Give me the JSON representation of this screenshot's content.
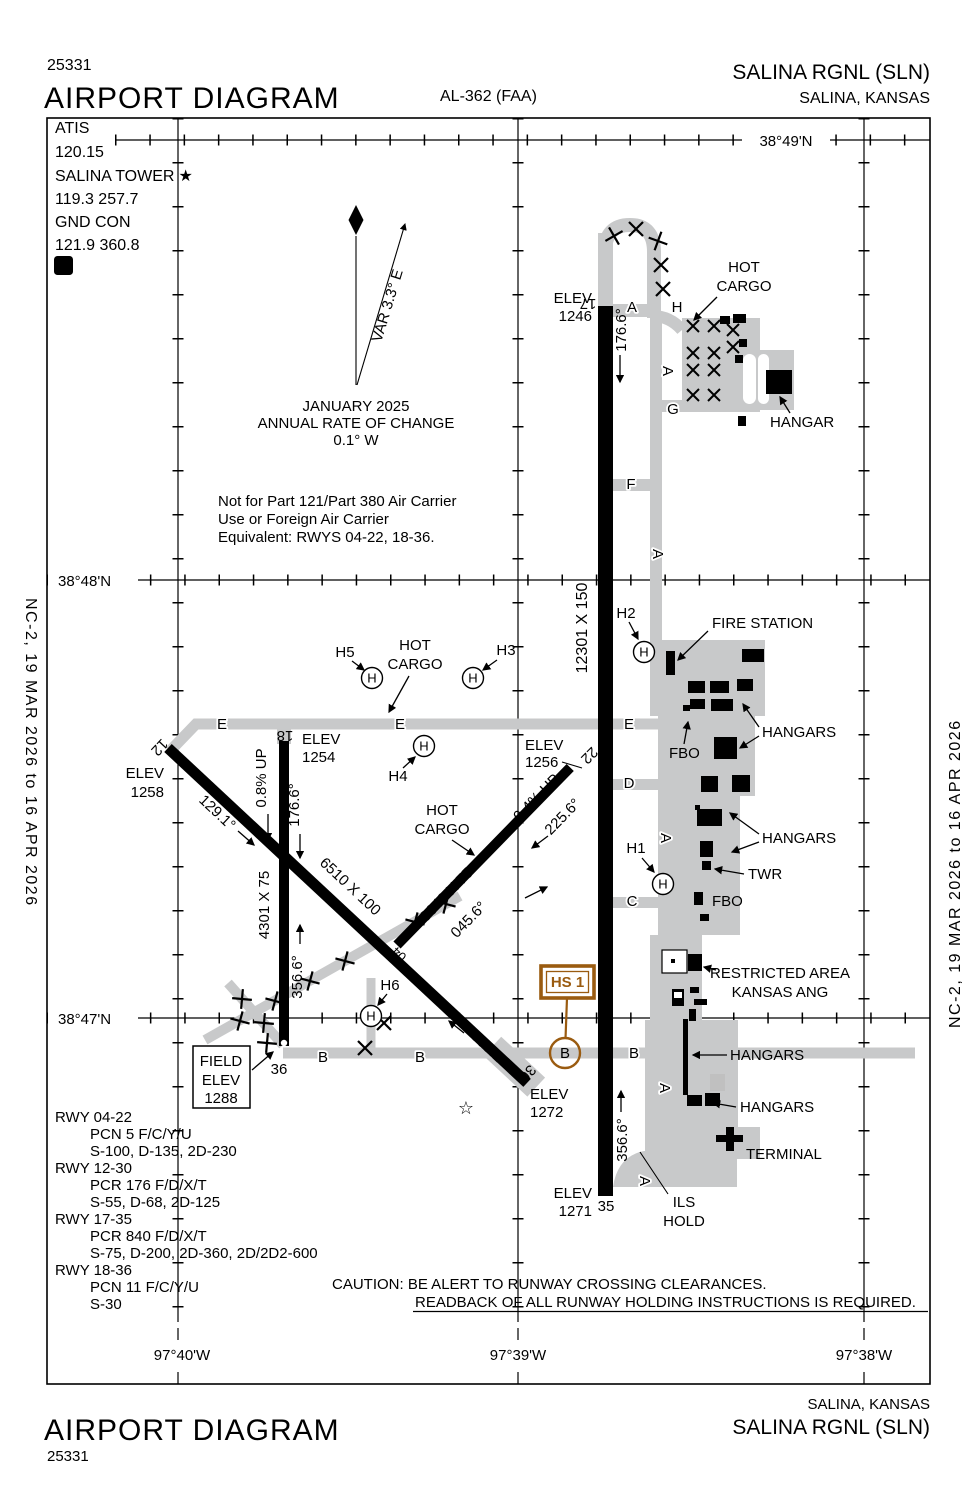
{
  "header": {
    "chart_code": "25331",
    "title": "AIRPORT DIAGRAM",
    "al_number": "AL-362 (FAA)",
    "airport": "SALINA RGNL  (SLN)",
    "city": "SALINA, KANSAS"
  },
  "footer": {
    "city": "SALINA, KANSAS",
    "airport": "SALINA RGNL  (SLN)",
    "title": "AIRPORT DIAGRAM",
    "chart_code": "25331"
  },
  "margin_note": "NC-2,  19 MAR 2026  to  16 APR 2026",
  "comm": {
    "atis_label": "ATIS",
    "atis_freq": "120.15",
    "tower_label": "SALINA TOWER",
    "tower_star": "★",
    "tower_freqs": "119.3  257.7",
    "gnd_label": "GND CON",
    "gnd_freqs": "121.9  360.8",
    "clnc_del": "D"
  },
  "north": {
    "variation": "VAR 3.3° E",
    "date": "JANUARY 2025",
    "rate1": "ANNUAL RATE OF CHANGE",
    "rate2": "0.1° W"
  },
  "notes": {
    "n1": "Not for Part 121/Part 380 Air Carrier",
    "n2": "Use or Foreign Air Carrier",
    "n3": "Equivalent: RWYS 04-22, 18-36."
  },
  "caution": {
    "line1": "CAUTION: BE ALERT TO RUNWAY CROSSING CLEARANCES.",
    "line2": "READBACK OF ALL RUNWAY HOLDING INSTRUCTIONS IS REQUIRED."
  },
  "grid": {
    "lat1": "38°49'N",
    "lat2": "38°48'N",
    "lat3": "38°47'N",
    "lon1": "97°40'W",
    "lon2": "97°39'W",
    "lon3": "97°38'W"
  },
  "field_elev": {
    "l1": "FIELD",
    "l2": "ELEV",
    "l3": "1288"
  },
  "runways": {
    "r1735": {
      "dim": "12301 X 150",
      "id17": "17",
      "elev17_l1": "ELEV",
      "elev17_l2": "1246",
      "hdg17": "176.6°",
      "id35": "35",
      "elev35_l1": "ELEV",
      "elev35_l2": "1271",
      "hdg35": "356.6°"
    },
    "r1836": {
      "dim": "4301 X 75",
      "id18": "18",
      "elev18_l1": "ELEV",
      "elev18_l2": "1254",
      "hdg18": "176.6°",
      "grade18": "0.8% UP",
      "id36": "36",
      "hdg36": "356.6°"
    },
    "r1230": {
      "dim": "6510 X 100",
      "id12": "12",
      "elev12_l1": "ELEV",
      "elev12_l2": "1258",
      "hdg12": "129.1°",
      "id30": "30",
      "hdg30": "309.1°",
      "elev30_l1": "ELEV",
      "elev30_l2": "1272"
    },
    "r0422": {
      "dim": "3648 X 75",
      "id04": "04",
      "hdg04": "045.6°",
      "id22": "22",
      "elev22_l1": "ELEV",
      "elev22_l2": "1256",
      "hdg22": "225.6°",
      "grade22": "0.4% UP"
    }
  },
  "taxiways": {
    "a": "A",
    "b": "B",
    "c": "C",
    "d": "D",
    "e": "E",
    "f": "F",
    "g": "G",
    "h": "H"
  },
  "helipads": {
    "h1": "H1",
    "h2": "H2",
    "h3": "H3",
    "h4": "H4",
    "h5": "H5",
    "h6": "H6",
    "symbol": "H"
  },
  "facilities": {
    "hot": "HOT",
    "cargo": "CARGO",
    "hangar": "HANGAR",
    "hangars": "HANGARS",
    "fire_station": "FIRE STATION",
    "fbo": "FBO",
    "twr": "TWR",
    "terminal": "TERMINAL",
    "restricted1": "RESTRICTED AREA",
    "restricted2": "KANSAS ANG",
    "ils1": "ILS",
    "ils2": "HOLD"
  },
  "hotspot": {
    "label": "HS 1",
    "circle": "B"
  },
  "runway_data": [
    {
      "rwy": "RWY 04-22",
      "pcn": "PCN 5 F/C/Y/U",
      "gear": "S-100, D-135, 2D-230"
    },
    {
      "rwy": "RWY 12-30",
      "pcn": "PCR 176 F/D/X/T",
      "gear": "S-55, D-68, 2D-125"
    },
    {
      "rwy": "RWY 17-35",
      "pcn": "PCR 840 F/D/X/T",
      "gear": "S-75, D-200, 2D-360, 2D/2D2-600"
    },
    {
      "rwy": "RWY 18-36",
      "pcn": "PCN 11 F/C/Y/U",
      "gear": "S-30"
    }
  ],
  "map_symbols": {
    "star": "☆"
  },
  "colors": {
    "taxiway": "#c8c9ca",
    "runway": "#000000",
    "hotspot": "#9a5b10"
  }
}
